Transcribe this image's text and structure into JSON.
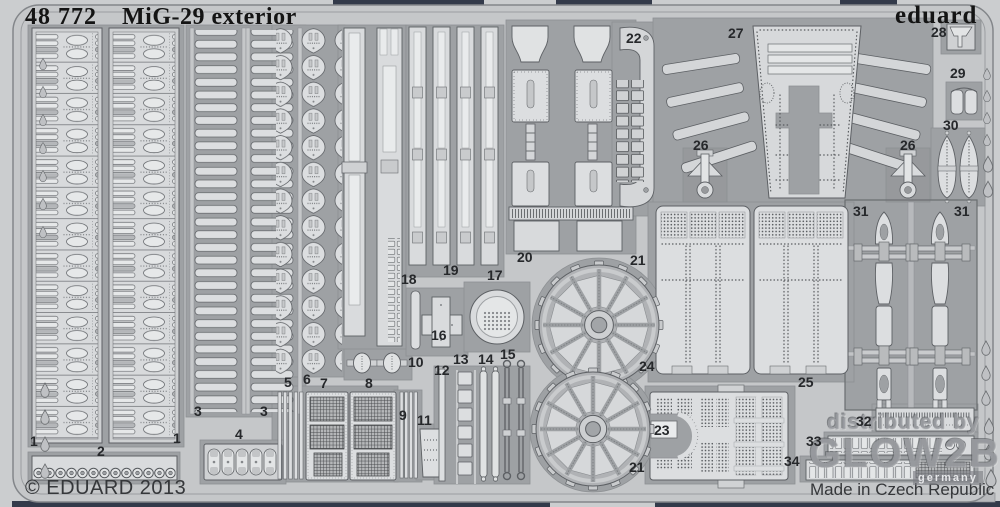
{
  "header": {
    "catalog_no": "48 772",
    "title": "MiG-29 exterior",
    "brand": "eduard"
  },
  "footer": {
    "copyright": "© EDUARD 2013",
    "origin": "Made in Czech Republic"
  },
  "watermark": {
    "line1": "distributed by",
    "line2": "GLOW2B",
    "line3": "germany"
  },
  "colors": {
    "background": "#cbcdcf",
    "sheet": "#c5c7c9",
    "pocket": "#9ea1a4",
    "part": "#dcdee0",
    "outline": "#5d6064",
    "ink": "#1a1a1a",
    "edge_navy": "#333a4a"
  },
  "part_labels": [
    {
      "n": "1",
      "x": 30,
      "y": 434
    },
    {
      "n": "2",
      "x": 97,
      "y": 444
    },
    {
      "n": "1",
      "x": 173,
      "y": 431
    },
    {
      "n": "3",
      "x": 194,
      "y": 404
    },
    {
      "n": "3",
      "x": 260,
      "y": 404
    },
    {
      "n": "4",
      "x": 235,
      "y": 427
    },
    {
      "n": "5",
      "x": 284,
      "y": 375
    },
    {
      "n": "6",
      "x": 303,
      "y": 372
    },
    {
      "n": "7",
      "x": 320,
      "y": 376
    },
    {
      "n": "8",
      "x": 365,
      "y": 376
    },
    {
      "n": "9",
      "x": 399,
      "y": 408
    },
    {
      "n": "10",
      "x": 408,
      "y": 355
    },
    {
      "n": "11",
      "x": 417,
      "y": 413
    },
    {
      "n": "12",
      "x": 434,
      "y": 363
    },
    {
      "n": "13",
      "x": 453,
      "y": 352
    },
    {
      "n": "14",
      "x": 478,
      "y": 352
    },
    {
      "n": "15",
      "x": 500,
      "y": 347
    },
    {
      "n": "16",
      "x": 431,
      "y": 328
    },
    {
      "n": "17",
      "x": 487,
      "y": 268
    },
    {
      "n": "18",
      "x": 401,
      "y": 272
    },
    {
      "n": "19",
      "x": 443,
      "y": 263
    },
    {
      "n": "20",
      "x": 517,
      "y": 250
    },
    {
      "n": "21",
      "x": 630,
      "y": 253
    },
    {
      "n": "21",
      "x": 629,
      "y": 460
    },
    {
      "n": "22",
      "x": 626,
      "y": 31
    },
    {
      "n": "23",
      "x": 654,
      "y": 423
    },
    {
      "n": "24",
      "x": 639,
      "y": 359
    },
    {
      "n": "25",
      "x": 798,
      "y": 375
    },
    {
      "n": "26",
      "x": 693,
      "y": 138
    },
    {
      "n": "26",
      "x": 900,
      "y": 138
    },
    {
      "n": "27",
      "x": 728,
      "y": 26
    },
    {
      "n": "28",
      "x": 931,
      "y": 25
    },
    {
      "n": "29",
      "x": 950,
      "y": 66
    },
    {
      "n": "30",
      "x": 943,
      "y": 118
    },
    {
      "n": "31",
      "x": 853,
      "y": 204
    },
    {
      "n": "31",
      "x": 954,
      "y": 204
    },
    {
      "n": "32",
      "x": 856,
      "y": 414
    },
    {
      "n": "33",
      "x": 806,
      "y": 434
    },
    {
      "n": "34",
      "x": 784,
      "y": 454
    }
  ]
}
